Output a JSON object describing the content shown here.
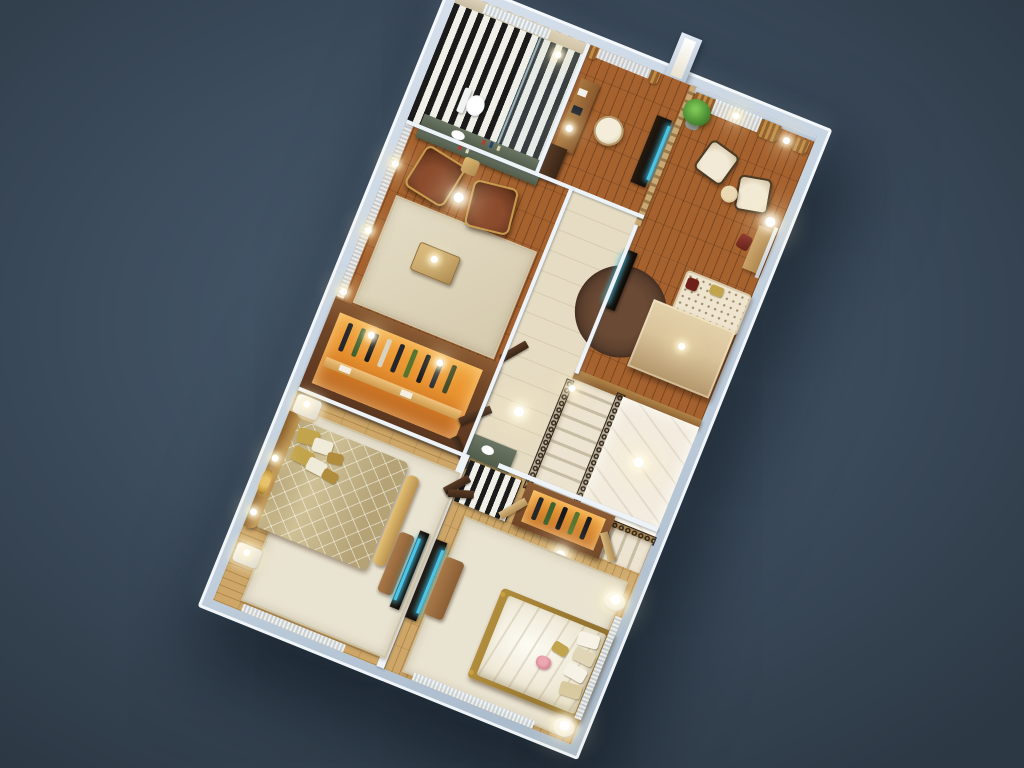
{
  "scene": {
    "description": "Photorealistic 3D cutaway floor plan of an apartment level, rotated on a dark slate backdrop; no visible text in the image",
    "rooms": [
      {
        "name": "bathroom",
        "floor": "black-white striped tile",
        "furniture": [
          "toilet",
          "glass shower",
          "marble vanity with sink",
          "window sheer"
        ]
      },
      {
        "name": "study",
        "floor": "dark wood planks",
        "furniture": [
          "desk with lamp",
          "cream desk chair",
          "tv-stand",
          "slatted wood divider",
          "tall dark cabinet"
        ]
      },
      {
        "name": "sitting-room",
        "floor": "dark wood planks",
        "furniture": [
          "two cream armchairs",
          "round ottoman",
          "potted plant",
          "dressing table with mirror",
          "red stool",
          "brown window drapes with sheers",
          "wall sconces"
        ]
      },
      {
        "name": "upper-hall",
        "floor": "dark wood planks",
        "furniture": [
          "light wood counter block",
          "dotted daybed",
          "dark round rug",
          "tv-stand"
        ]
      },
      {
        "name": "lounge-nook",
        "floor": "dark wood planks",
        "furniture": [
          "two brown leather armchairs with gold frames",
          "gold side table",
          "gold coffee table",
          "beige area rug",
          "marble console with bottles",
          "sheer curtains"
        ]
      },
      {
        "name": "walk-in-wardrobe",
        "floor": "wood",
        "furniture": [
          "orange-lit closet with hanging clothes",
          "shelf",
          "double dark doors"
        ]
      },
      {
        "name": "corridor",
        "floor": "beige stone",
        "furniture": [
          "marble vanity with sink",
          "open doors",
          "floor lamp"
        ]
      },
      {
        "name": "staircase",
        "floor": "white marble landing",
        "furniture": [
          "two stair flights",
          "wrought-iron scroll railing",
          "chandelier glow"
        ]
      },
      {
        "name": "master-bedroom",
        "floor": "light wood planks",
        "furniture": [
          "double bed with gold quilted duvet",
          "gold and cream pillows",
          "gold headboard",
          "foot bench",
          "two white nightstands",
          "gold wall art",
          "wall sconces",
          "tv panel",
          "sofa bench",
          "cream rug",
          "sheer curtains"
        ]
      },
      {
        "name": "second-bedroom",
        "floor": "light wood planks",
        "furniture": [
          "double bed with cream bedding",
          "pink shell pillow",
          "gold bed frame",
          "two white nightstands with lamps",
          "tv panel",
          "sofa bench",
          "large cream rug",
          "orange-lit closet",
          "striped rug",
          "double doors"
        ]
      }
    ]
  },
  "colors": {
    "bg-center": "#495b6e",
    "bg-mid": "#3d4d5e",
    "bg-edge": "#2c3844",
    "wall-top": "#d6e0ec",
    "wall-mid": "#c2d0de",
    "wall-side": "#a7b8c9",
    "floor-beige": "#e6dcc3",
    "wood-dark": "#a5622f",
    "wood-light": "#cda668",
    "stripe-dark": "#1b1b1b",
    "stripe-light": "#f0efe8",
    "marble": "#f3ecdf",
    "rug-cream": "#e9e3d1",
    "rug-dark": "#53392a",
    "leather": "#6e3a22",
    "gold-trim": "#c79a4e",
    "cream-chair": "#efe7d2",
    "duvet-gold": "#cfc096",
    "pillow-gold": "#c2a44c",
    "bed-cream": "#ece5d1",
    "closet-glow": "#e8912f",
    "closet-frame": "#6f4526",
    "drape": "#c08a47",
    "plant": "#4f9136",
    "counter": "#d9c39b",
    "door-wood": "#4a3020",
    "tv-screen": "#49c6e8",
    "railing": "#2e231a",
    "marble-counter": "#515c4b"
  }
}
